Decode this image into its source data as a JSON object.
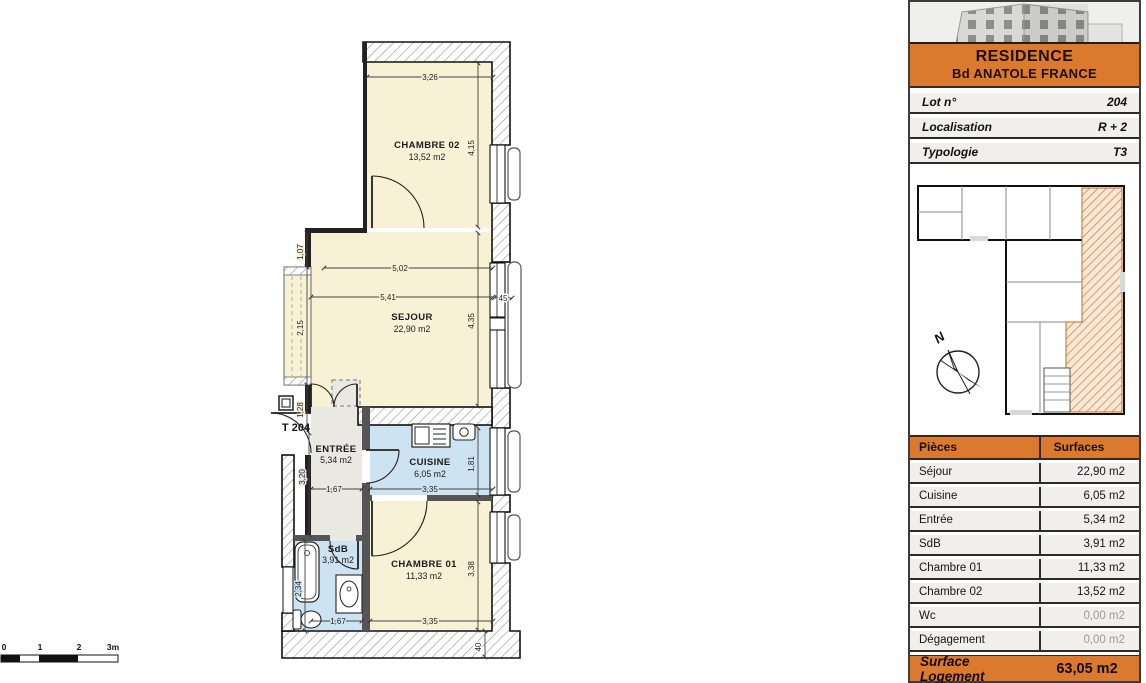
{
  "colors": {
    "accent_orange": "#db7a2e",
    "row_gray": "#f0efec",
    "room_cream": "#f7f1d6",
    "room_blue": "#cde3f1",
    "room_gray": "#e9e8e2",
    "muted_text": "#9b9b9b",
    "line_dark": "#2b2b2b"
  },
  "plan": {
    "unit_label": "T 204",
    "rooms": [
      {
        "name": "CHAMBRE 02",
        "area": "13,52 m2"
      },
      {
        "name": "SEJOUR",
        "area": "22,90 m2"
      },
      {
        "name": "ENTRÉE",
        "area": "5,34 m2"
      },
      {
        "name": "CUISINE",
        "area": "6,05 m2"
      },
      {
        "name": "SdB",
        "area": "3,91 m2"
      },
      {
        "name": "CHAMBRE 01",
        "area": "11,33 m2"
      }
    ],
    "dims": {
      "ch2_width": "3,26",
      "ch2_height": "4,15",
      "sejour_top": "5,02",
      "sejour_mid": "5,41",
      "sejour_height": "4,35",
      "window_mullion": "45",
      "left_top": "1,07",
      "left_mid": "2,15",
      "left_low": "1,28",
      "entree_height": "3,20",
      "entree_width": "1,67",
      "cuisine_width": "3,35",
      "cuisine_height": "1,81",
      "sdb_height": "2,34",
      "sdb_width": "1,67",
      "ch1_width": "3,35",
      "ch1_height": "3,38",
      "bottom_wall": "40"
    },
    "scalebar": {
      "t0": "0",
      "t1": "1",
      "t2": "2",
      "t3": "3m"
    }
  },
  "sidebar": {
    "header": {
      "line1": "RESIDENCE",
      "line2": "Bd ANATOLE FRANCE"
    },
    "info_rows": [
      {
        "label": "Lot n°",
        "value": "204"
      },
      {
        "label": "Localisation",
        "value": "R + 2"
      },
      {
        "label": "Typologie",
        "value": "T3"
      }
    ],
    "compass_label": "N",
    "table": {
      "headers": [
        "Pièces",
        "Surfaces"
      ],
      "rows": [
        {
          "label": "Séjour",
          "value": "22,90 m2"
        },
        {
          "label": "Cuisine",
          "value": "6,05 m2"
        },
        {
          "label": "Entrée",
          "value": "5,34 m2"
        },
        {
          "label": "SdB",
          "value": "3,91 m2"
        },
        {
          "label": "Chambre 01",
          "value": "11,33 m2"
        },
        {
          "label": "Chambre 02",
          "value": "13,52 m2"
        },
        {
          "label": "Wc",
          "value": "0,00 m2"
        },
        {
          "label": "Dégagement",
          "value": "0,00 m2"
        }
      ],
      "footer": {
        "label": "Surface  Logement",
        "value": "63,05 m2"
      }
    }
  }
}
